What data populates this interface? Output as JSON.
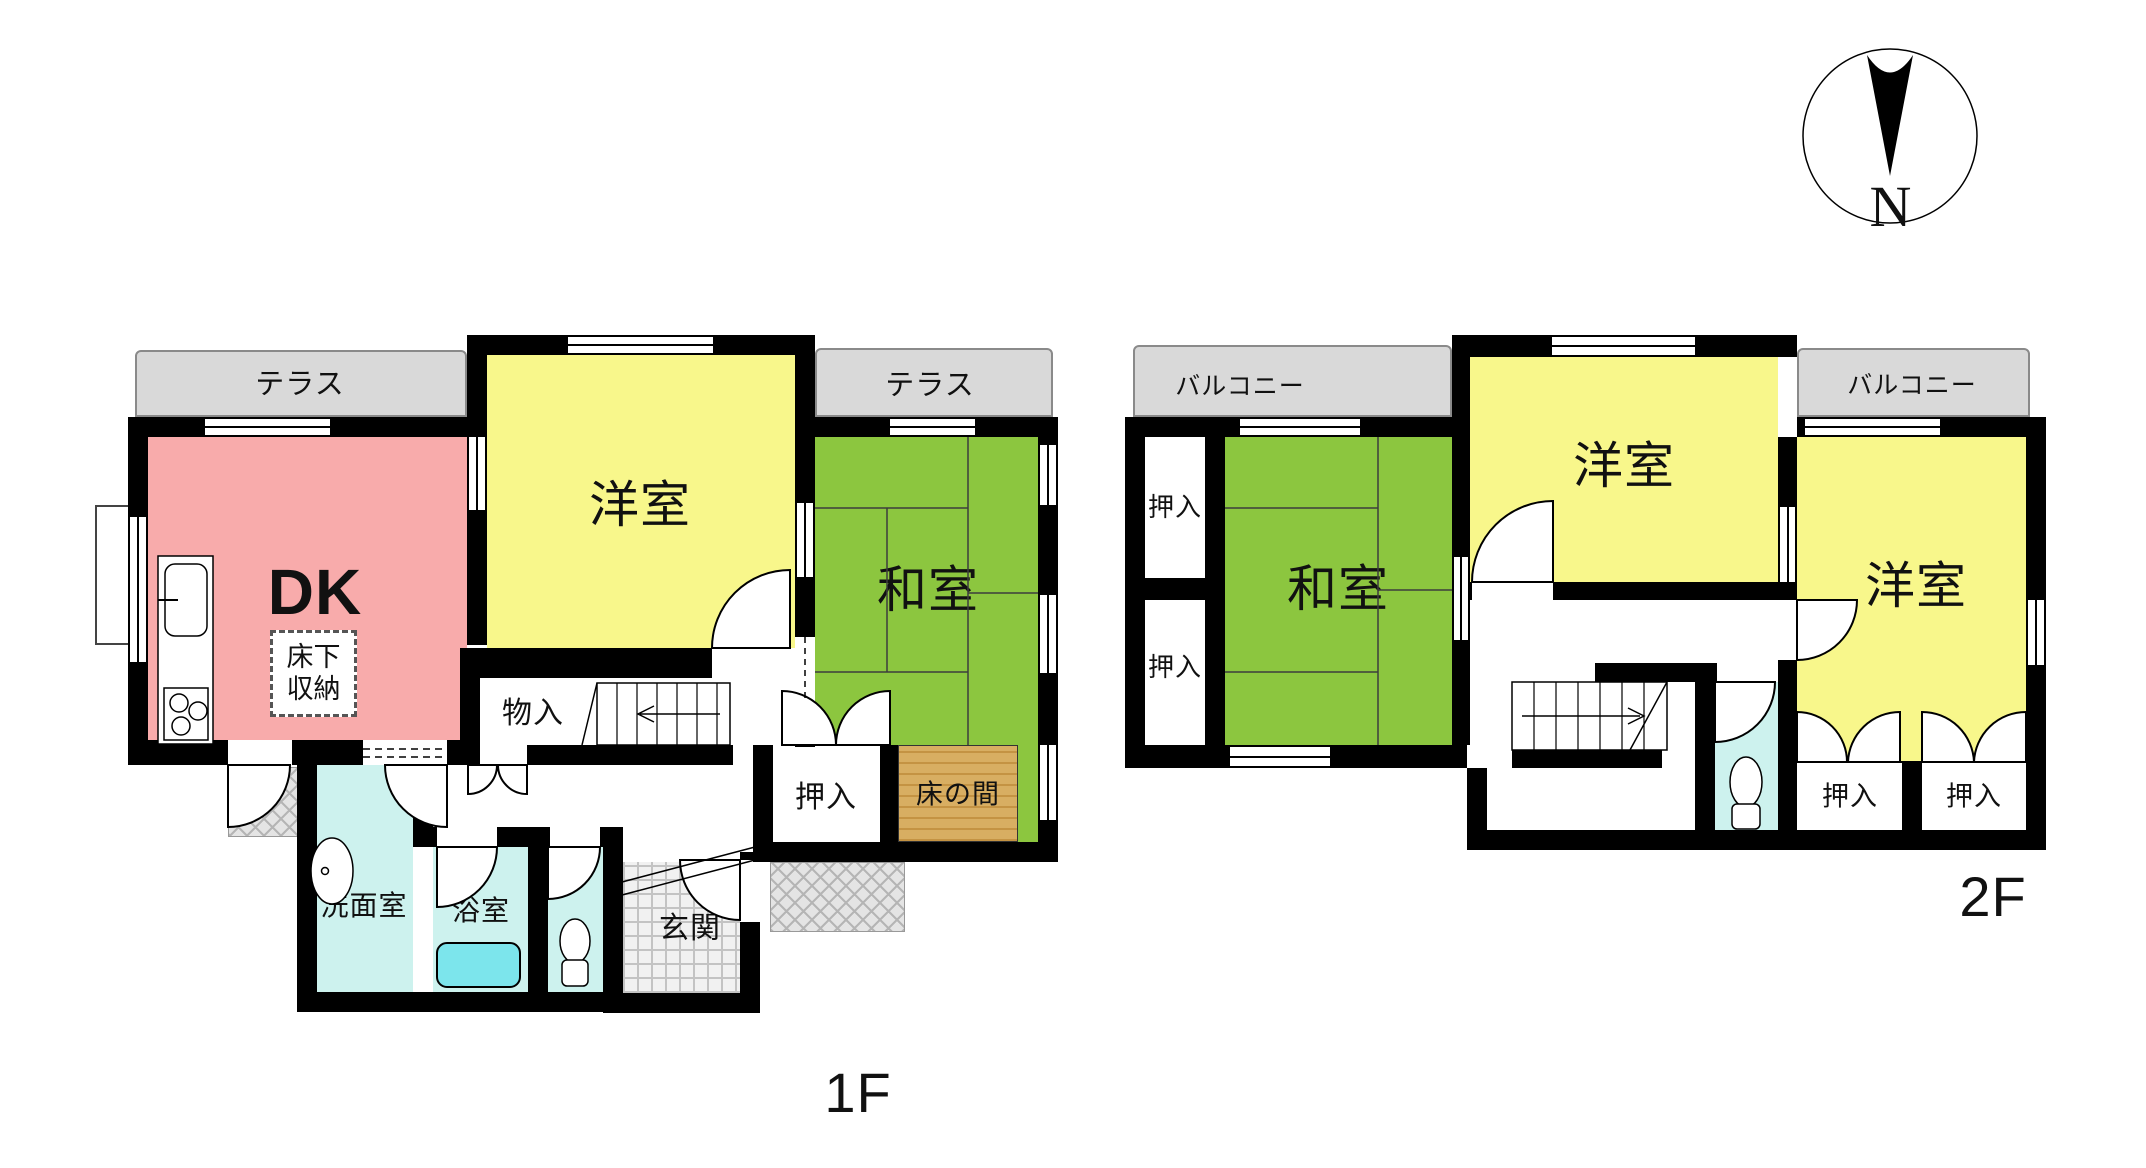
{
  "floor1": {
    "floor_label": "1F",
    "terrace_left": "テラス",
    "terrace_right": "テラス",
    "dk": "DK",
    "underfloor_storage": "床下収納",
    "western_room": "洋室",
    "japanese_room": "和室",
    "storage": "物入",
    "closet": "押入",
    "tokonoma": "床の間",
    "washroom": "洗面室",
    "bathroom": "浴室",
    "entrance": "玄関"
  },
  "floor2": {
    "floor_label": "2F",
    "balcony_left": "バルコニー",
    "balcony_right": "バルコニー",
    "closet_top_left": "押入",
    "closet_bottom_left": "押入",
    "japanese_room": "和室",
    "western_room_center": "洋室",
    "western_room_right": "洋室",
    "closet_right_1": "押入",
    "closet_right_2": "押入"
  },
  "compass": {
    "north_label": "N"
  },
  "colors": {
    "wall": "#000000",
    "text": "#111111",
    "tatami": "#8cc63f",
    "room_yellow": "#f8f78b",
    "room_pink": "#f8abab",
    "room_cyan": "#cdf2ee",
    "tub_cyan": "#7ce5ec",
    "terrace_gray": "#d9d9d9",
    "tokonoma_tan": "#d8ae62"
  }
}
